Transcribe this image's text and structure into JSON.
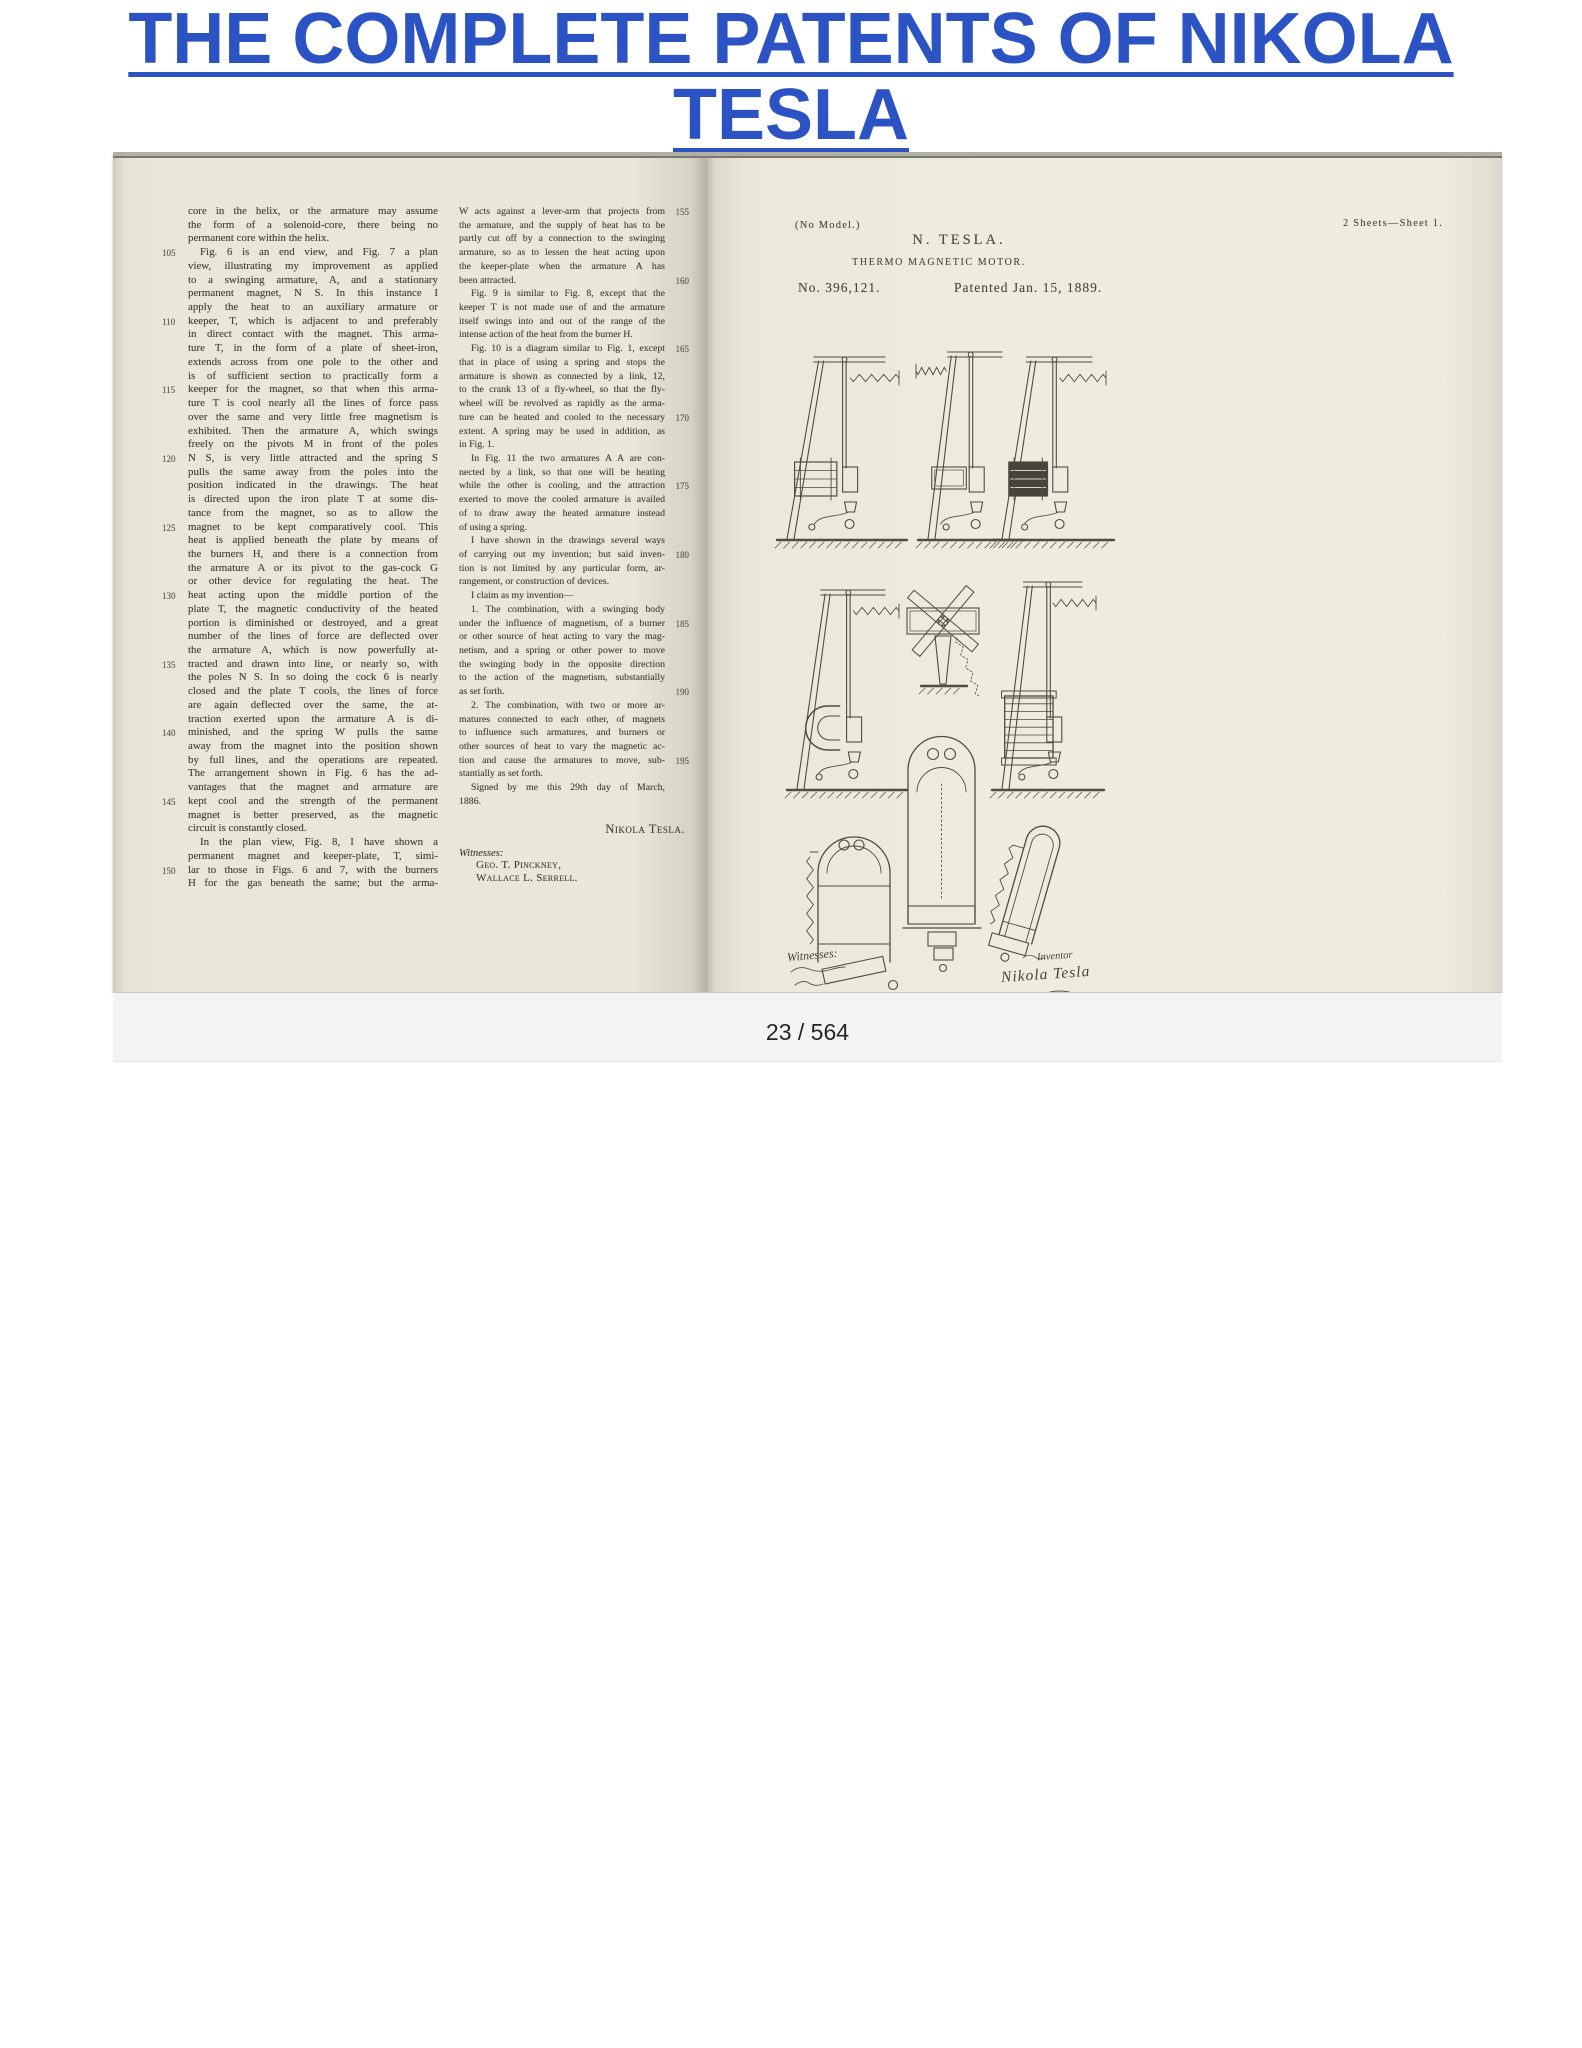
{
  "header": {
    "title": "THE COMPLETE PATENTS OF NIKOLA TESLA"
  },
  "viewer": {
    "page_indicator": "23 / 564"
  },
  "book": {
    "left_page": {
      "col1": {
        "lines": [
          {
            "t": "core in the helix, or the armature may assume"
          },
          {
            "t": "the form of a solenoid-core, there being no"
          },
          {
            "t": "permanent core within the helix.",
            "e": 1
          },
          {
            "n": "105",
            "t": "Fig. 6 is an end view, and Fig. 7 a plan",
            "i": 1
          },
          {
            "t": "view, illustrating my improvement as applied"
          },
          {
            "t": "to a swinging armature, A, and a stationary"
          },
          {
            "t": "permanent magnet, N S. In this instance I"
          },
          {
            "t": "apply the heat to an auxiliary armature or"
          },
          {
            "n": "110",
            "t": "keeper, T, which is adjacent to and preferably"
          },
          {
            "t": "in direct contact with the magnet. This arma-"
          },
          {
            "t": "ture T, in the form of a plate of sheet-iron,"
          },
          {
            "t": "extends across from one pole to the other and"
          },
          {
            "t": "is of sufficient section to practically form a"
          },
          {
            "n": "115",
            "t": "keeper for the magnet, so that when this arma-"
          },
          {
            "t": "ture T is cool nearly all the lines of force pass"
          },
          {
            "t": "over the same and very little free magnetism is"
          },
          {
            "t": "exhibited. Then the armature A, which swings"
          },
          {
            "t": "freely on the pivots M in front of the poles"
          },
          {
            "n": "120",
            "t": "N S, is very little attracted and the spring S"
          },
          {
            "t": "pulls the same away from the poles into the"
          },
          {
            "t": "position indicated in the drawings. The heat"
          },
          {
            "t": "is directed upon the iron plate T at some dis-"
          },
          {
            "t": "tance from the magnet, so as to allow the"
          },
          {
            "n": "125",
            "t": "magnet to be kept comparatively cool. This"
          },
          {
            "t": "heat is applied beneath the plate by means of"
          },
          {
            "t": "the burners H, and there is a connection from"
          },
          {
            "t": "the armature A or its pivot to the gas-cock G"
          },
          {
            "t": "or other device for regulating the heat. The"
          },
          {
            "n": "130",
            "t": "heat acting upon the middle portion of the"
          },
          {
            "t": "plate T, the magnetic conductivity of the heated"
          },
          {
            "t": "portion is diminished or destroyed, and a great"
          },
          {
            "t": "number of the lines of force are deflected over"
          },
          {
            "t": "the armature A, which is now powerfully at-"
          },
          {
            "n": "135",
            "t": "tracted and drawn into line, or nearly so, with"
          },
          {
            "t": "the poles N S. In so doing the cock 6 is nearly"
          },
          {
            "t": "closed and the plate T cools, the lines of force"
          },
          {
            "t": "are again deflected over the same, the at-"
          },
          {
            "t": "traction exerted upon the armature A is di-"
          },
          {
            "n": "140",
            "t": "minished, and the spring W pulls the same"
          },
          {
            "t": "away from the magnet into the position shown"
          },
          {
            "t": "by full lines, and the operations are repeated."
          },
          {
            "t": "The arrangement shown in Fig. 6 has the ad-"
          },
          {
            "t": "vantages that the magnet and armature are"
          },
          {
            "n": "145",
            "t": "kept cool and the strength of the permanent"
          },
          {
            "t": "magnet is better preserved, as the magnetic"
          },
          {
            "t": "circuit is constantly closed.",
            "e": 1
          },
          {
            "t": "In the plan view, Fig. 8, I have shown a",
            "i": 1
          },
          {
            "t": "permanent magnet and keeper-plate, T, simi-"
          },
          {
            "n": "150",
            "t": "lar to those in Figs. 6 and 7, with the burners"
          },
          {
            "t": "H for the gas beneath the same; but the arma-"
          }
        ]
      },
      "col2": {
        "lines": [
          {
            "n": "155",
            "t": "W acts against a lever-arm that projects from"
          },
          {
            "t": "the armature, and the supply of heat has to be"
          },
          {
            "t": "partly cut off by a connection to the swinging"
          },
          {
            "t": "armature, so as to lessen the heat acting upon"
          },
          {
            "t": "the keeper-plate when the armature A has"
          },
          {
            "n": "160",
            "t": "been attracted.",
            "e": 1
          },
          {
            "t": "Fig. 9 is similar to Fig. 8, except that the",
            "i": 1
          },
          {
            "t": "keeper T is not made use of and the armature"
          },
          {
            "t": "itself swings into and out of the range of the"
          },
          {
            "t": "intense action of the heat from the burner H.",
            "e": 1
          },
          {
            "n": "165",
            "t": "Fig. 10 is a diagram similar to Fig. 1, except",
            "i": 1
          },
          {
            "t": "that in place of using a spring and stops the"
          },
          {
            "t": "armature is shown as connected by a link, 12,"
          },
          {
            "t": "to the crank 13 of a fly-wheel, so that the fly-"
          },
          {
            "t": "wheel will be revolved as rapidly as the arma-"
          },
          {
            "n": "170",
            "t": "ture can be heated and cooled to the necessary"
          },
          {
            "t": "extent. A spring may be used in addition, as"
          },
          {
            "t": "in Fig. 1.",
            "e": 1
          },
          {
            "t": "In Fig. 11 the two armatures A A are con-",
            "i": 1
          },
          {
            "t": "nected by a link, so that one will be heating"
          },
          {
            "n": "175",
            "t": "while the other is cooling, and the attraction"
          },
          {
            "t": "exerted to move the cooled armature is availed"
          },
          {
            "t": "of to draw away the heated armature instead"
          },
          {
            "t": "of using a spring.",
            "e": 1
          },
          {
            "t": "I have shown in the drawings several ways",
            "i": 1
          },
          {
            "n": "180",
            "t": "of carrying out my invention; but said inven-"
          },
          {
            "t": "tion is not limited by any particular form, ar-"
          },
          {
            "t": "rangement, or construction of devices.",
            "e": 1
          },
          {
            "t": "I claim as my invention—",
            "e": 1,
            "i": 1
          },
          {
            "t": "1. The combination, with a swinging body",
            "i": 1
          },
          {
            "n": "185",
            "t": "under the influence of magnetism, of a burner"
          },
          {
            "t": "or other source of heat acting to vary the mag-"
          },
          {
            "t": "netism, and a spring or other power to move"
          },
          {
            "t": "the swinging body in the opposite direction"
          },
          {
            "t": "to the action of the magnetism, substantially"
          },
          {
            "n": "190",
            "t": "as set forth.",
            "e": 1
          },
          {
            "t": "2. The combination, with two or more ar-",
            "i": 1
          },
          {
            "t": "matures connected to each other, of magnets"
          },
          {
            "t": "to influence such armatures, and burners or"
          },
          {
            "t": "other sources of heat to vary the magnetic ac-"
          },
          {
            "n": "195",
            "t": "tion and cause the armatures to move, sub-"
          },
          {
            "t": "stantially as set forth.",
            "e": 1
          },
          {
            "t": "Signed by me this 29th day of March,",
            "i": 1
          },
          {
            "t": "1886.",
            "e": 1
          }
        ],
        "signature": "Nikola Tesla.",
        "witnesses_label": "Witnesses:",
        "witnesses": [
          "Geo. T. Pinckney,",
          "Wallace L. Serrell."
        ]
      }
    },
    "patent_sheet": {
      "no_model": "(No Model.)",
      "sheets_note": "2 Sheets—Sheet 1.",
      "inventor_name": "N. TESLA.",
      "invention_title": "THERMO MAGNETIC MOTOR.",
      "patent_number": "No. 396,121.",
      "patented_date": "Patented Jan. 15, 1889.",
      "figure_labels": [
        {
          "text": "Fig. 2",
          "x": 124,
          "y": 181
        },
        {
          "text": "Fig. 1",
          "x": 236,
          "y": 170
        },
        {
          "text": "Fig. 3",
          "x": 342,
          "y": 181
        },
        {
          "text": "Fig. 4",
          "x": 138,
          "y": 422
        },
        {
          "text": "Fig. 6.",
          "x": 230,
          "y": 414
        },
        {
          "text": "Fig. 5",
          "x": 326,
          "y": 410
        },
        {
          "text": "Fig. 7",
          "x": 232,
          "y": 574
        },
        {
          "text": "Fig. 8",
          "x": 100,
          "y": 678
        },
        {
          "text": "Fig. 9",
          "x": 354,
          "y": 712
        }
      ],
      "figure_letters": [
        {
          "ch": "M",
          "x": 142,
          "y": 210
        },
        {
          "ch": "W",
          "x": 172,
          "y": 240
        },
        {
          "ch": "F",
          "x": 84,
          "y": 292
        },
        {
          "ch": "P",
          "x": 146,
          "y": 300
        },
        {
          "ch": "A",
          "x": 150,
          "y": 331
        },
        {
          "ch": "H",
          "x": 140,
          "y": 374
        },
        {
          "ch": "W",
          "x": 210,
          "y": 214
        },
        {
          "ch": "F",
          "x": 226,
          "y": 300
        },
        {
          "ch": "P",
          "x": 270,
          "y": 300
        },
        {
          "ch": "A",
          "x": 258,
          "y": 332
        },
        {
          "ch": "H",
          "x": 252,
          "y": 374
        },
        {
          "ch": "P",
          "x": 332,
          "y": 296
        },
        {
          "ch": "P'",
          "x": 372,
          "y": 300
        },
        {
          "ch": "F",
          "x": 300,
          "y": 330
        },
        {
          "ch": "A",
          "x": 352,
          "y": 340
        },
        {
          "ch": "H",
          "x": 346,
          "y": 380
        },
        {
          "ch": "P",
          "x": 140,
          "y": 496
        },
        {
          "ch": "P'",
          "x": 170,
          "y": 528
        },
        {
          "ch": "F",
          "x": 96,
          "y": 546
        },
        {
          "ch": "W",
          "x": 118,
          "y": 590
        },
        {
          "ch": "H",
          "x": 150,
          "y": 622
        },
        {
          "ch": "T",
          "x": 260,
          "y": 448
        },
        {
          "ch": "N",
          "x": 204,
          "y": 478
        },
        {
          "ch": "S",
          "x": 264,
          "y": 478
        },
        {
          "ch": "Q",
          "x": 328,
          "y": 492
        },
        {
          "ch": "P",
          "x": 352,
          "y": 520
        },
        {
          "ch": "F",
          "x": 298,
          "y": 560
        },
        {
          "ch": "A",
          "x": 362,
          "y": 590
        },
        {
          "ch": "H",
          "x": 352,
          "y": 626
        },
        {
          "ch": "T",
          "x": 230,
          "y": 668
        },
        {
          "ch": "N",
          "x": 208,
          "y": 768
        },
        {
          "ch": "S",
          "x": 257,
          "y": 768
        },
        {
          "ch": "W",
          "x": 95,
          "y": 744
        },
        {
          "ch": "T",
          "x": 143,
          "y": 750
        },
        {
          "ch": "A",
          "x": 139,
          "y": 797
        },
        {
          "ch": "S",
          "x": 174,
          "y": 806
        },
        {
          "ch": "W",
          "x": 290,
          "y": 692
        }
      ],
      "script": {
        "witnesses": "Witnesses:",
        "inventor": "Inventor",
        "signature": "Nikola Tesla"
      }
    }
  },
  "colors": {
    "title_link": "#2b53c4",
    "paper_left": "#e9e6da",
    "paper_right": "#eeecdf",
    "ink": "#46432f",
    "pager_bg": "#f3f3f3"
  }
}
